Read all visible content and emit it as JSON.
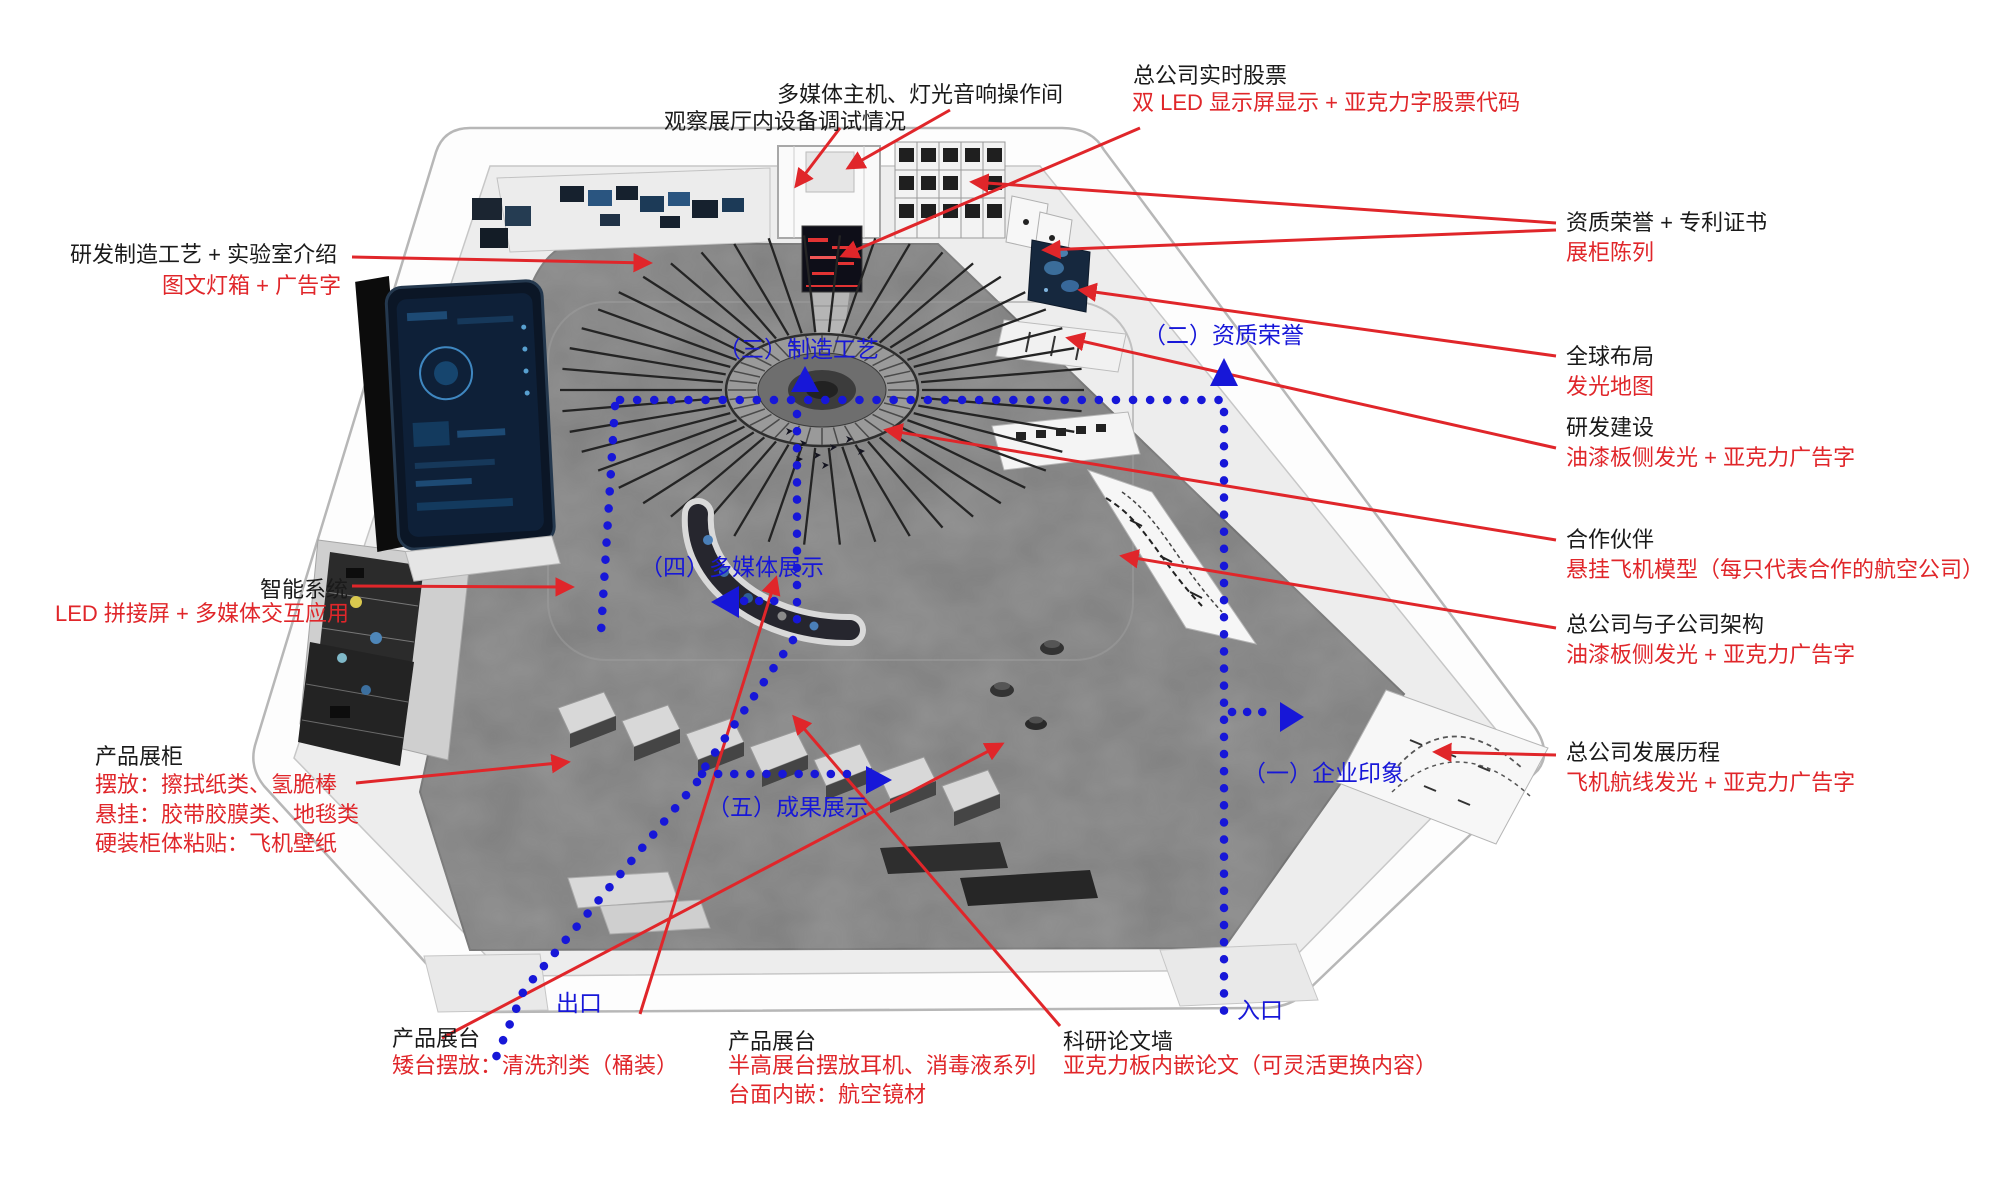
{
  "colors": {
    "ink": "#1a1a1a",
    "red": "#e0262a",
    "blue": "#1717d8",
    "floor": "#7f7f7f"
  },
  "top": {
    "control_room_line1": "多媒体主机、灯光音响操作间",
    "control_room_line2": "观察展厅内设备调试情况",
    "stock_title": "总公司实时股票",
    "stock_desc": "双 LED 显示屏显示 + 亚克力字股票代码"
  },
  "right_column": [
    {
      "title": "资质荣誉 + 专利证书",
      "desc": "展柜陈列"
    },
    {
      "title": "全球布局",
      "desc": "发光地图"
    },
    {
      "title": "研发建设",
      "desc": "油漆板侧发光 + 亚克力广告字"
    },
    {
      "title": "合作伙伴",
      "desc": "悬挂飞机模型（每只代表合作的航空公司）"
    },
    {
      "title": "总公司与子公司架构",
      "desc": "油漆板侧发光 + 亚克力广告字"
    },
    {
      "title": "总公司发展历程",
      "desc": "飞机航线发光 + 亚克力广告字"
    }
  ],
  "left_labels": {
    "lab_title": "研发制造工艺 + 实验室介绍",
    "lab_desc": "图文灯箱 + 广告字",
    "smart_title": "智能系统",
    "smart_desc": "LED 拼接屏 + 多媒体交互应用",
    "cabinet_title": "产品展柜",
    "cabinet_line1": "摆放：擦拭纸类、氢脆棒",
    "cabinet_line2": "悬挂：胶带胶膜类、地毯类",
    "cabinet_line3": "硬装柜体粘贴：飞机壁纸"
  },
  "bottom_labels": {
    "stand_left_title": "产品展台",
    "stand_left_desc": "矮台摆放：清洗剂类（桶装）",
    "stand_center_title": "产品展台",
    "stand_center_line1": "半高展台摆放耳机、消毒液系列",
    "stand_center_line2": "台面内嵌：航空镜材",
    "paper_wall_title": "科研论文墙",
    "paper_wall_desc": "亚克力板内嵌论文（可灵活更换内容）"
  },
  "zones": {
    "zone1": "（一）企业印象",
    "zone2": "（二）资质荣誉",
    "zone3": "（三）制造工艺",
    "zone4": "（四）多媒体展示",
    "zone5": "（五）成果展示",
    "entrance": "入口",
    "exit": "出口"
  }
}
